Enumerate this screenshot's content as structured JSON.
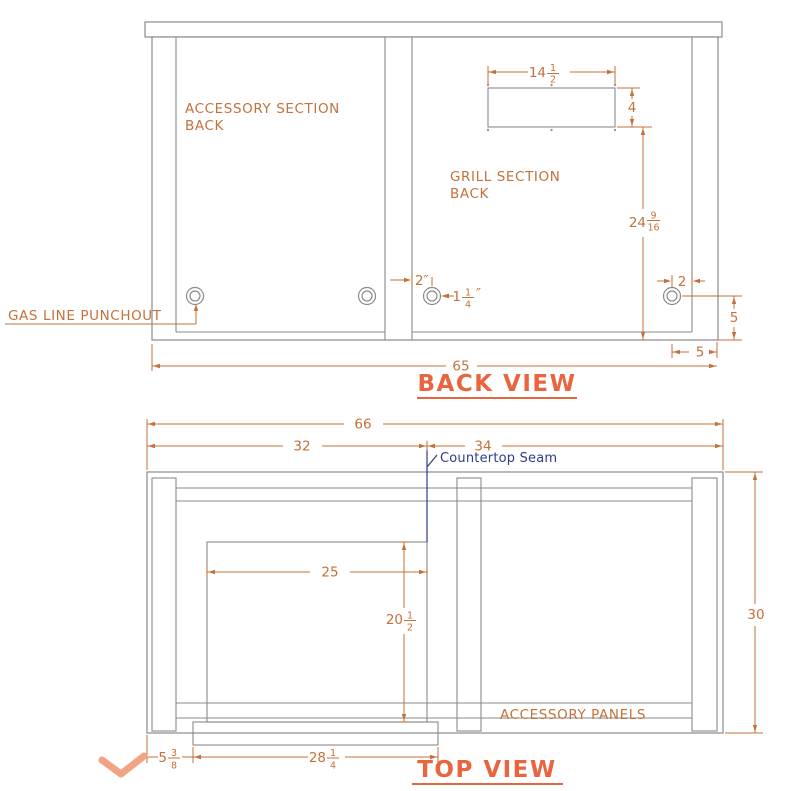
{
  "colors": {
    "line_gray": "#8a8a8a",
    "dimension_orange": "#c4713b",
    "title_orange": "#e8653f",
    "seam_blue": "#2e3a8c",
    "checkmark_salmon": "#f2a384"
  },
  "back_view": {
    "title": "BACK VIEW",
    "labels": {
      "accessory_section": [
        "ACCESSORY SECTION",
        "BACK"
      ],
      "grill_section": [
        "GRILL SECTION",
        "BACK"
      ],
      "gas_line_punchout": "GAS LINE PUNCHOUT"
    },
    "dims": {
      "vent_width": {
        "whole": "14",
        "num": "1",
        "den": "2"
      },
      "vent_height": "4",
      "vent_to_bottom": {
        "whole": "24",
        "num": "9",
        "den": "16"
      },
      "punchout_inset_mid": "2″",
      "punchout_diameter": {
        "whole": "1",
        "num": "1",
        "den": "4",
        "suffix": "″"
      },
      "punchout_inset_right": "2",
      "punchout_above_bottom": "5",
      "punchout_from_side": "5",
      "cabinet_width": "65"
    }
  },
  "top_view": {
    "title": "TOP VIEW",
    "labels": {
      "countertop_seam": "Countertop Seam",
      "accessory_panels": "ACCESSORY PANELS"
    },
    "dims": {
      "total_width": "66",
      "grill_side_width": "32",
      "accessory_side_width": "34",
      "cutout_width": "25",
      "cutout_depth": {
        "whole": "20",
        "num": "1",
        "den": "2"
      },
      "island_depth": "30",
      "front_left_offset": {
        "whole": "5",
        "num": "3",
        "den": "8"
      },
      "front_width": {
        "whole": "28",
        "num": "1",
        "den": "4"
      }
    }
  }
}
